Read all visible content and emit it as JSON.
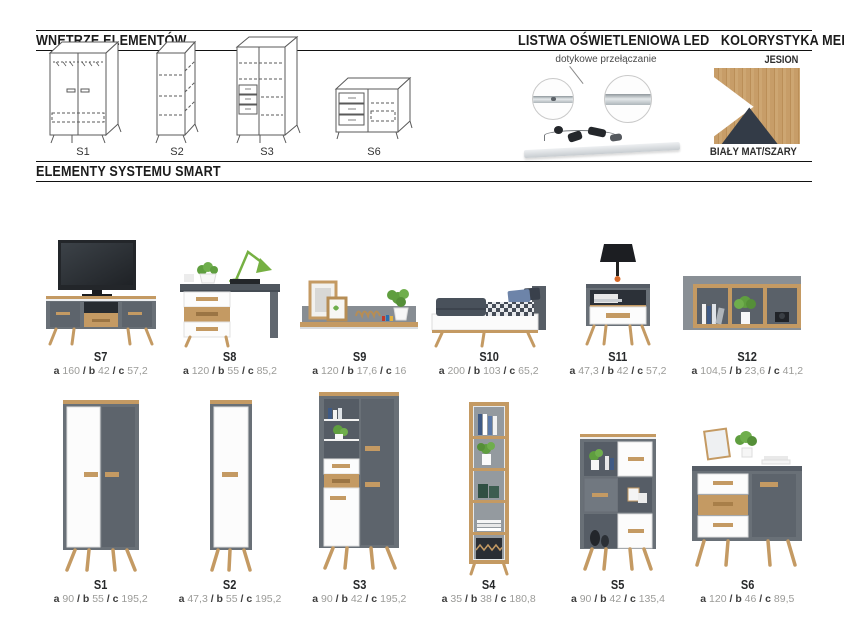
{
  "sections": {
    "interiors_title": "WNĘTRZE ELEMENTÓW",
    "led_title": "LISTWA OŚWIETLENIOWA LED",
    "colors_title": "KOLORYSTYKA MEBLI",
    "system_title": "ELEMENTY SYSTEMU SMART"
  },
  "interiors": {
    "items": [
      "S1",
      "S2",
      "S3",
      "S6"
    ]
  },
  "led": {
    "caption": "dotykowe przełączanie"
  },
  "colors": {
    "top_label": "JESION",
    "bottom_label": "BIAŁY MAT/SZARY",
    "wood_hex": "#c49a63",
    "white_hex": "#ffffff",
    "dark_hex": "#333b47",
    "gray_hex": "#697077"
  },
  "dim_labels": {
    "a": "a",
    "b": "b",
    "c": "c",
    "sep": "/"
  },
  "products": {
    "row1": [
      {
        "code": "S7",
        "a": "160",
        "b": "42",
        "c": "57,2"
      },
      {
        "code": "S8",
        "a": "120",
        "b": "55",
        "c": "85,2"
      },
      {
        "code": "S9",
        "a": "120",
        "b": "17,6",
        "c": "16"
      },
      {
        "code": "S10",
        "a": "200",
        "b": "103",
        "c": "65,2"
      },
      {
        "code": "S11",
        "a": "47,3",
        "b": "42",
        "c": "57,2"
      },
      {
        "code": "S12",
        "a": "104,5",
        "b": "23,6",
        "c": "41,2"
      }
    ],
    "row2": [
      {
        "code": "S1",
        "a": "90",
        "b": "55",
        "c": "195,2"
      },
      {
        "code": "S2",
        "a": "47,3",
        "b": "55",
        "c": "195,2"
      },
      {
        "code": "S3",
        "a": "90",
        "b": "42",
        "c": "195,2"
      },
      {
        "code": "S4",
        "a": "35",
        "b": "38",
        "c": "180,8"
      },
      {
        "code": "S5",
        "a": "90",
        "b": "42",
        "c": "135,4"
      },
      {
        "code": "S6",
        "a": "120",
        "b": "46",
        "c": "89,5"
      }
    ]
  }
}
